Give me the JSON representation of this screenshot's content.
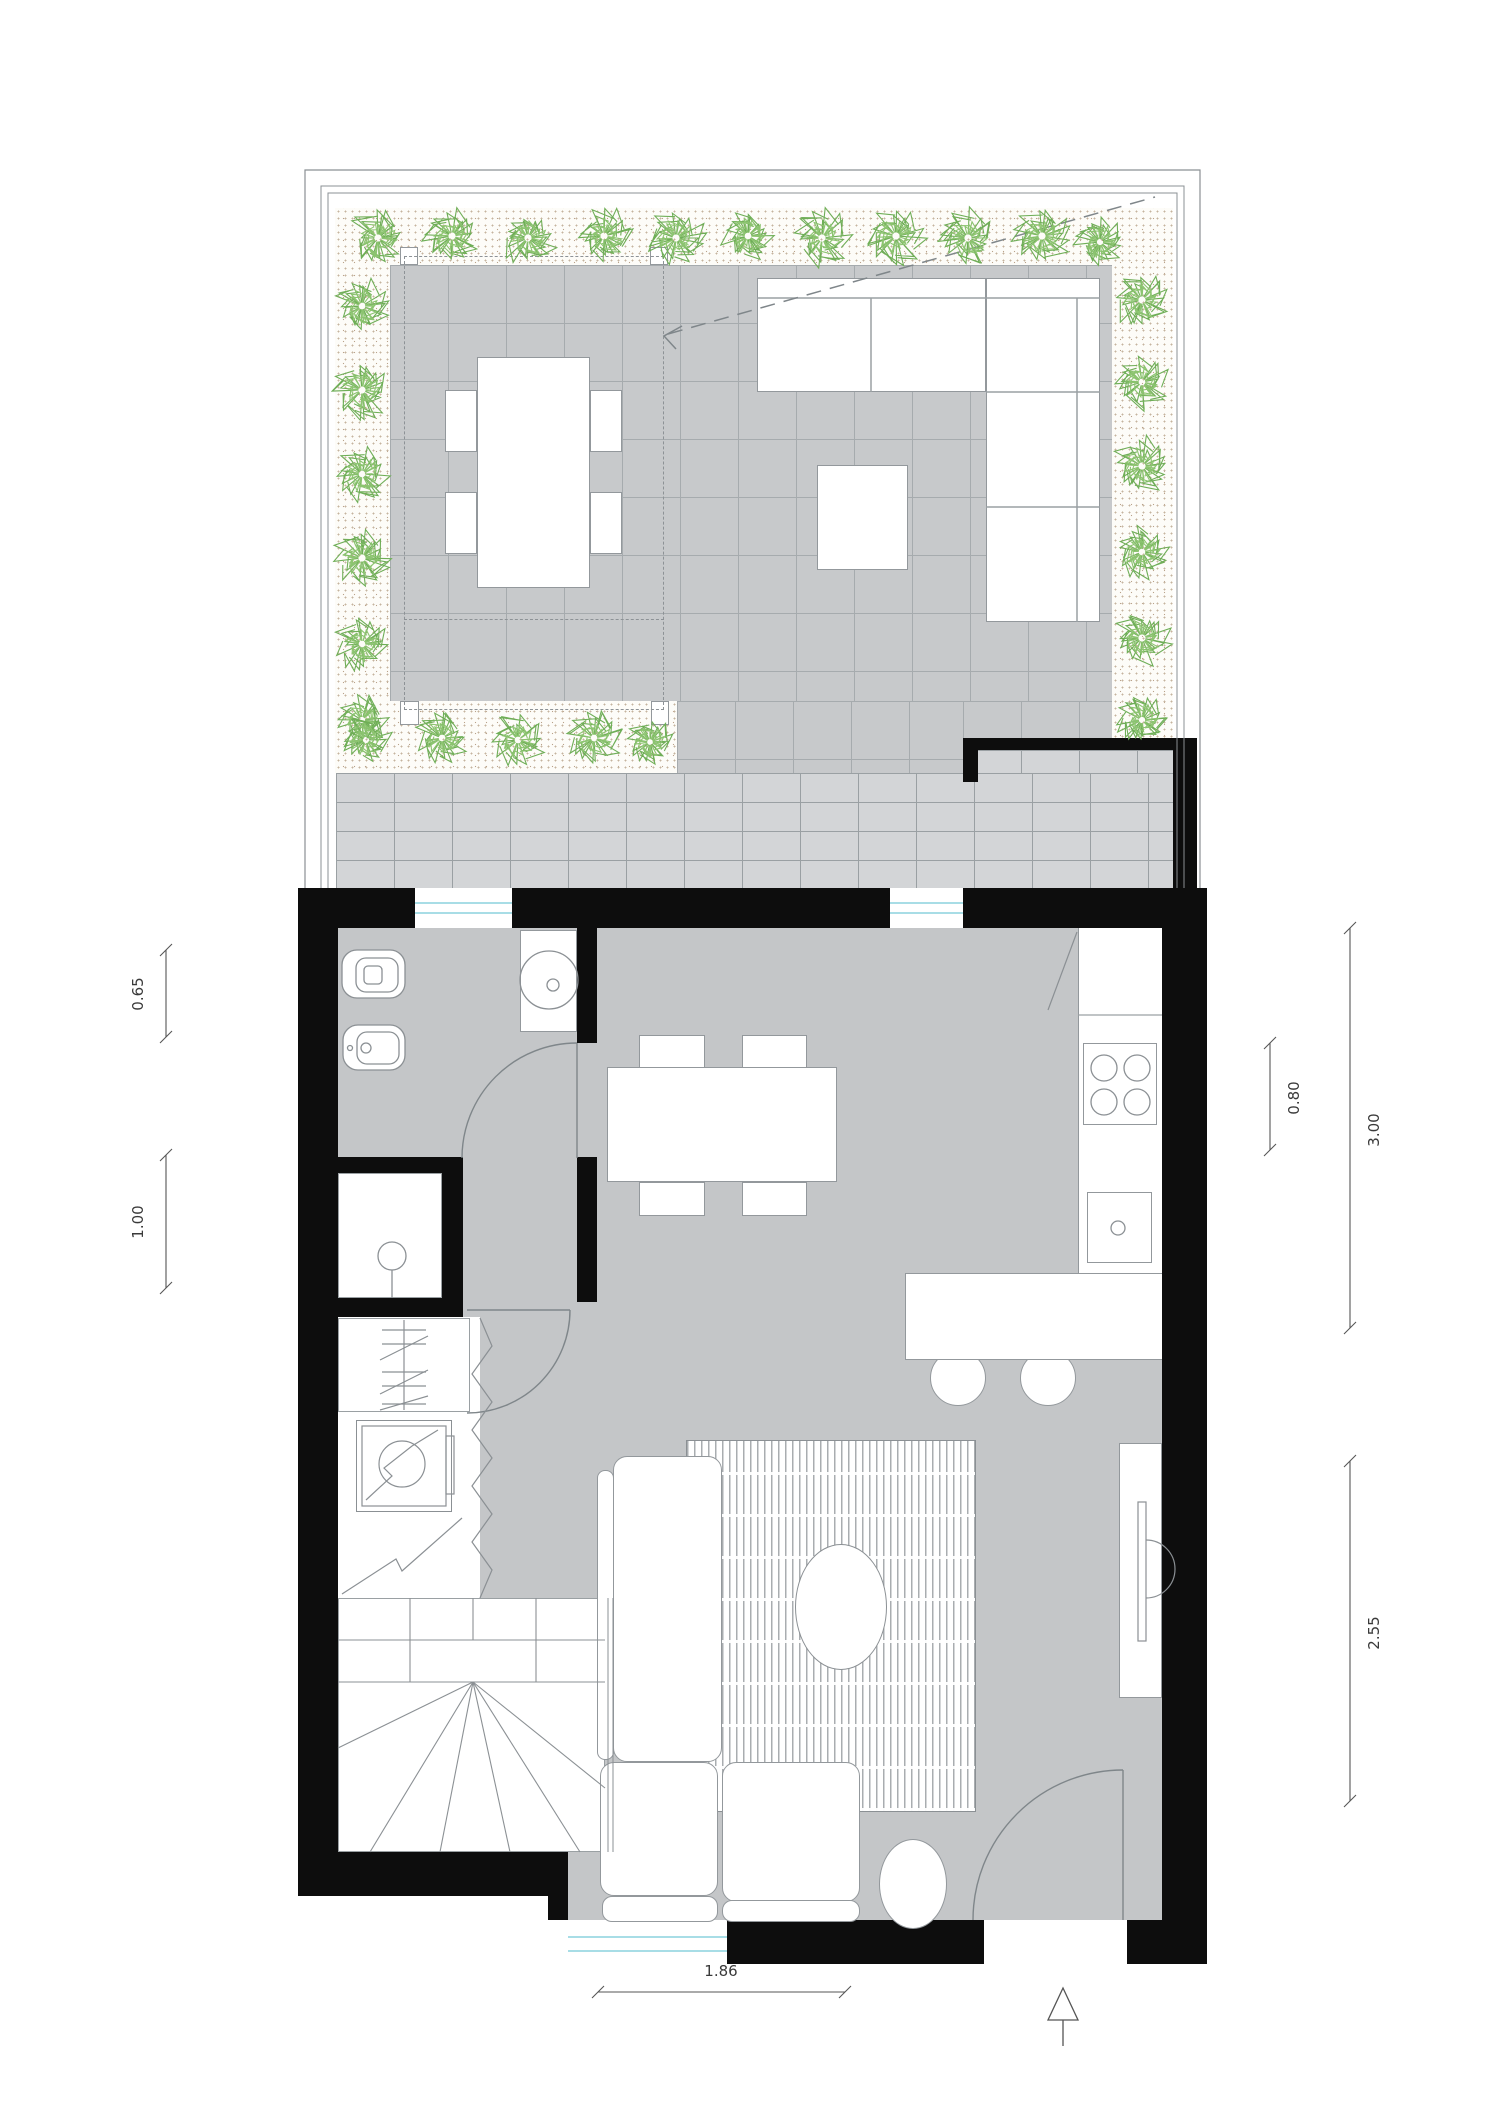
{
  "drawing": {
    "type": "architectural-floor-plan",
    "level": "ground-floor-with-roof-garden",
    "visible_text_labels_only": "dimension strings"
  },
  "dimensions": {
    "left_top": "0.65",
    "left_bottom": "1.00",
    "right_inner": "0.80",
    "right_upper": "3.00",
    "right_lower": "2.55",
    "bottom": "1.86"
  },
  "colors": {
    "wall": "#0d0d0d",
    "interior_floor": "#c4c6c8",
    "terrace_paving": "#c7c9cb",
    "brick_paving": "#d3d5d7",
    "planting_bed": "#fdfcf8",
    "plant_green": "#6fae57",
    "plant_green_light": "#8cc470",
    "glazing_cyan": "#a8dde6",
    "linework": "#8b9094",
    "dimension_line": "#555555"
  },
  "rooms": {
    "garden": [
      "planting-beds",
      "terrace-paving",
      "pergola-posts",
      "outdoor-dining-table",
      "outdoor-sofa",
      "outdoor-coffee-table"
    ],
    "court": [
      "brick-paving",
      "court-walls"
    ],
    "bathroom": [
      "toilet",
      "bidet",
      "washbasin",
      "door"
    ],
    "shower_room": [
      "shower-tray",
      "shower-head"
    ],
    "utility": [
      "coat-closet",
      "washing-machine",
      "accordion-door"
    ],
    "stair": [
      "winder-stair",
      "break-line"
    ],
    "kitchen": [
      "counter",
      "stove-4-burners",
      "sink",
      "peninsula",
      "stool",
      "stool"
    ],
    "dining": [
      "table",
      "chair",
      "chair",
      "chair",
      "chair"
    ],
    "living": [
      "l-sofa",
      "rug",
      "round-coffee-table",
      "tv-unit",
      "pouf",
      "entry-door"
    ]
  },
  "garden": {
    "posts": [
      [
        400,
        247
      ],
      [
        650,
        247
      ],
      [
        400,
        701
      ],
      [
        651,
        701
      ]
    ],
    "plants": [
      [
        378,
        238,
        30
      ],
      [
        452,
        236,
        30
      ],
      [
        528,
        238,
        30
      ],
      [
        604,
        236,
        30
      ],
      [
        676,
        238,
        30
      ],
      [
        748,
        236,
        28
      ],
      [
        822,
        238,
        30
      ],
      [
        896,
        236,
        30
      ],
      [
        968,
        238,
        30
      ],
      [
        1042,
        236,
        30
      ],
      [
        1100,
        242,
        26
      ],
      [
        1142,
        300,
        30
      ],
      [
        1142,
        382,
        28
      ],
      [
        1142,
        466,
        30
      ],
      [
        1142,
        552,
        28
      ],
      [
        1142,
        638,
        30
      ],
      [
        1142,
        720,
        26
      ],
      [
        362,
        306,
        28
      ],
      [
        362,
        390,
        30
      ],
      [
        362,
        474,
        28
      ],
      [
        362,
        558,
        30
      ],
      [
        362,
        644,
        28
      ],
      [
        362,
        720,
        26
      ],
      [
        366,
        740,
        26
      ],
      [
        442,
        738,
        28
      ],
      [
        518,
        740,
        28
      ],
      [
        594,
        738,
        28
      ],
      [
        650,
        742,
        24
      ]
    ]
  },
  "north_arrow": {
    "present": true,
    "direction": "up"
  }
}
